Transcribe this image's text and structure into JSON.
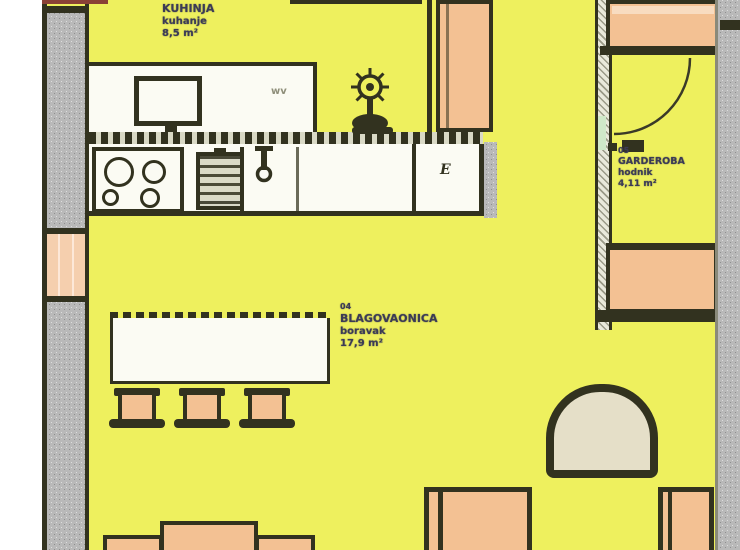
{
  "document_type": "apartment floor plan (scanned drawing)",
  "rooms": {
    "kitchen": {
      "lines": [
        "KUHINJA",
        "kuhanje",
        "8,5 m²"
      ]
    },
    "living": {
      "lines": [
        "04",
        "BLAGOVAONICA",
        "boravak",
        "17,9 m²"
      ]
    },
    "closet": {
      "lines": [
        "05",
        "GARDEROBA",
        "hodnik",
        "4,11 m²"
      ]
    }
  },
  "annotations": {
    "counter_outlet": "E",
    "cabinet_code": "wv"
  },
  "colors": {
    "floor_yellow": "#eef05e",
    "furniture_orange": "#f3c193",
    "window_peach": "#f5cfae",
    "outline_ink": "#32321f",
    "wall_gray": "#b9b9b9",
    "upholstery_beige": "#e5dfc8",
    "fixture_white": "#fbfbf3",
    "label_text": "#3b3b55"
  }
}
